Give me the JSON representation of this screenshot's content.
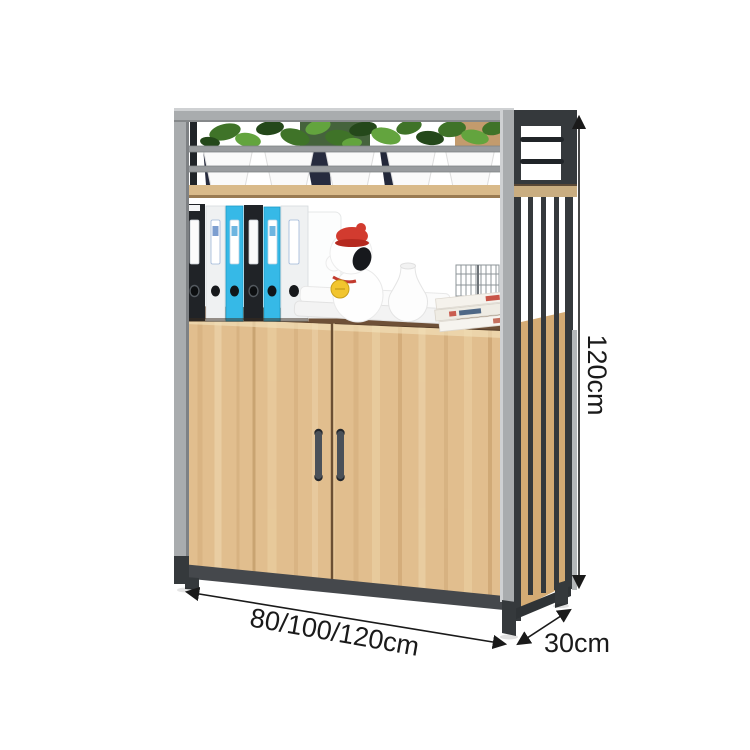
{
  "annotations": {
    "height": {
      "label": "120cm"
    },
    "width": {
      "label": "80/100/120cm"
    },
    "depth": {
      "label": "30cm"
    }
  },
  "icons": {
    "height_arrow": "double-headed-arrow-vertical",
    "width_arrow": "double-headed-arrow-diagonal",
    "depth_arrow": "double-headed-arrow-diagonal"
  },
  "colors": {
    "background": "#ffffff",
    "frame_silver": "#a9acae",
    "frame_silver_light": "#cfd1d3",
    "frame_dark": "#35393c",
    "frame_darker": "#202428",
    "rail_silver": "#999c9f",
    "wood_door": "#e1be8e",
    "wood_shelf": "#d9ba8a",
    "wood_side": "#d4ab74",
    "wood_top": "#6e5037",
    "base_dark": "#45484c",
    "binder_black": "#202327",
    "binder_white": "#eff1f2",
    "binder_cyan": "#36b9e7",
    "plant_green": "#3f7328",
    "plant_green_dark": "#24481a",
    "plant_green_light": "#63a43e",
    "cap_red": "#d23b2f",
    "bell_yellow": "#f2c52e",
    "annotation": "#1a1a1a"
  }
}
